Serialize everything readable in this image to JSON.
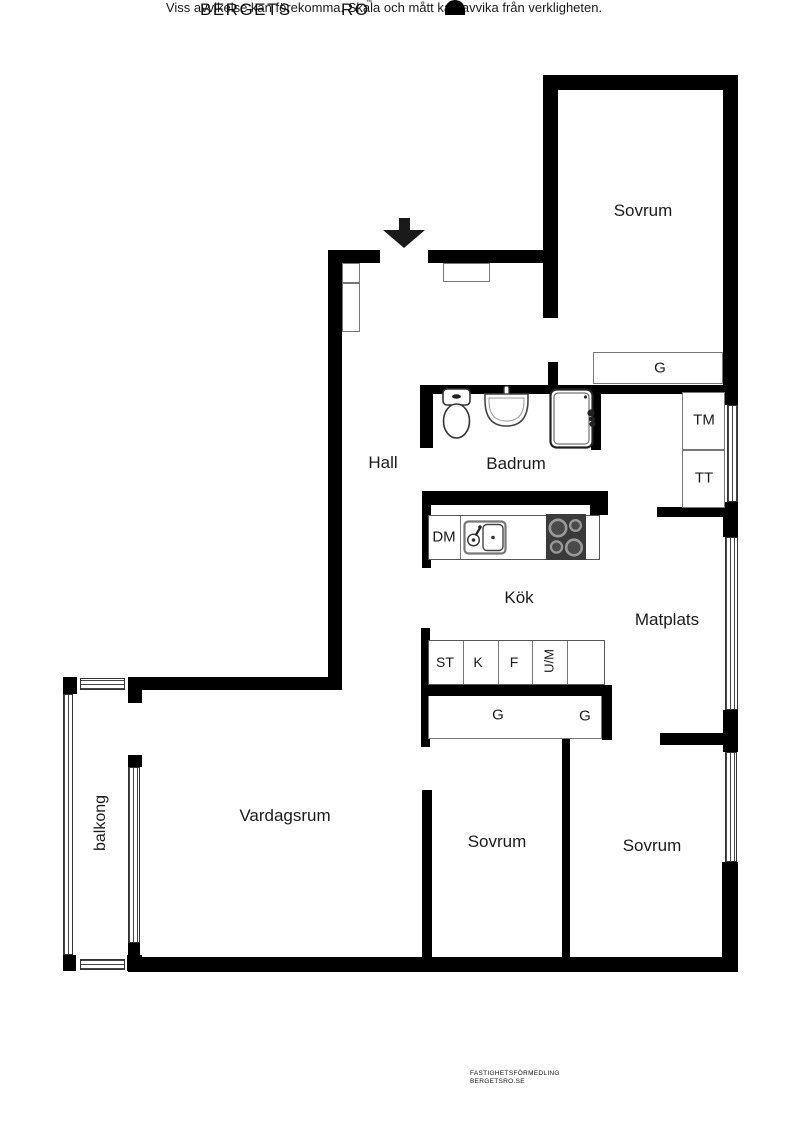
{
  "plan": {
    "rooms": {
      "sovrum_top": "Sovrum",
      "hall": "Hall",
      "badrum": "Badrum",
      "kok": "Kök",
      "matplats": "Matplats",
      "vardagsrum": "Vardagsrum",
      "sovrum_mid": "Sovrum",
      "sovrum_right": "Sovrum",
      "balkong": "balkong"
    },
    "fixtures": {
      "garderob_top": "G",
      "tvattmaskin": "TM",
      "torktumlare": "TT",
      "diskmaskin": "DM",
      "stad": "ST",
      "kyl": "K",
      "frys": "F",
      "ugn_micro": "U/M",
      "garderob_left": "G",
      "garderob_right": "G"
    },
    "icons": {
      "entrance-arrow": "filled-down-arrow",
      "toilet-icon": "toilet-plan-symbol",
      "washbasin-icon": "basin-plan-symbol",
      "shower-icon": "shower-cabin-plan-symbol",
      "stove-icon": "cooktop-four-burners",
      "kitchen-sink-icon": "sink-with-faucet",
      "brand-logo": "black-semicircle"
    },
    "colors": {
      "wall": "#000000",
      "background": "#ffffff",
      "thin_line": "#777777",
      "stove": "#3a3a3a"
    }
  },
  "footer": {
    "disclaimer": "Viss avvikelse kan förekomma. Skala och mått kan avvika från verkligheten.",
    "brand_word1": "BERGETS",
    "brand_word2": "RO",
    "trademark": "™",
    "logo_text_line1": "FASTIGHETSFÖRMEDLING",
    "logo_text_line2": "BERGETSRO.SE"
  }
}
